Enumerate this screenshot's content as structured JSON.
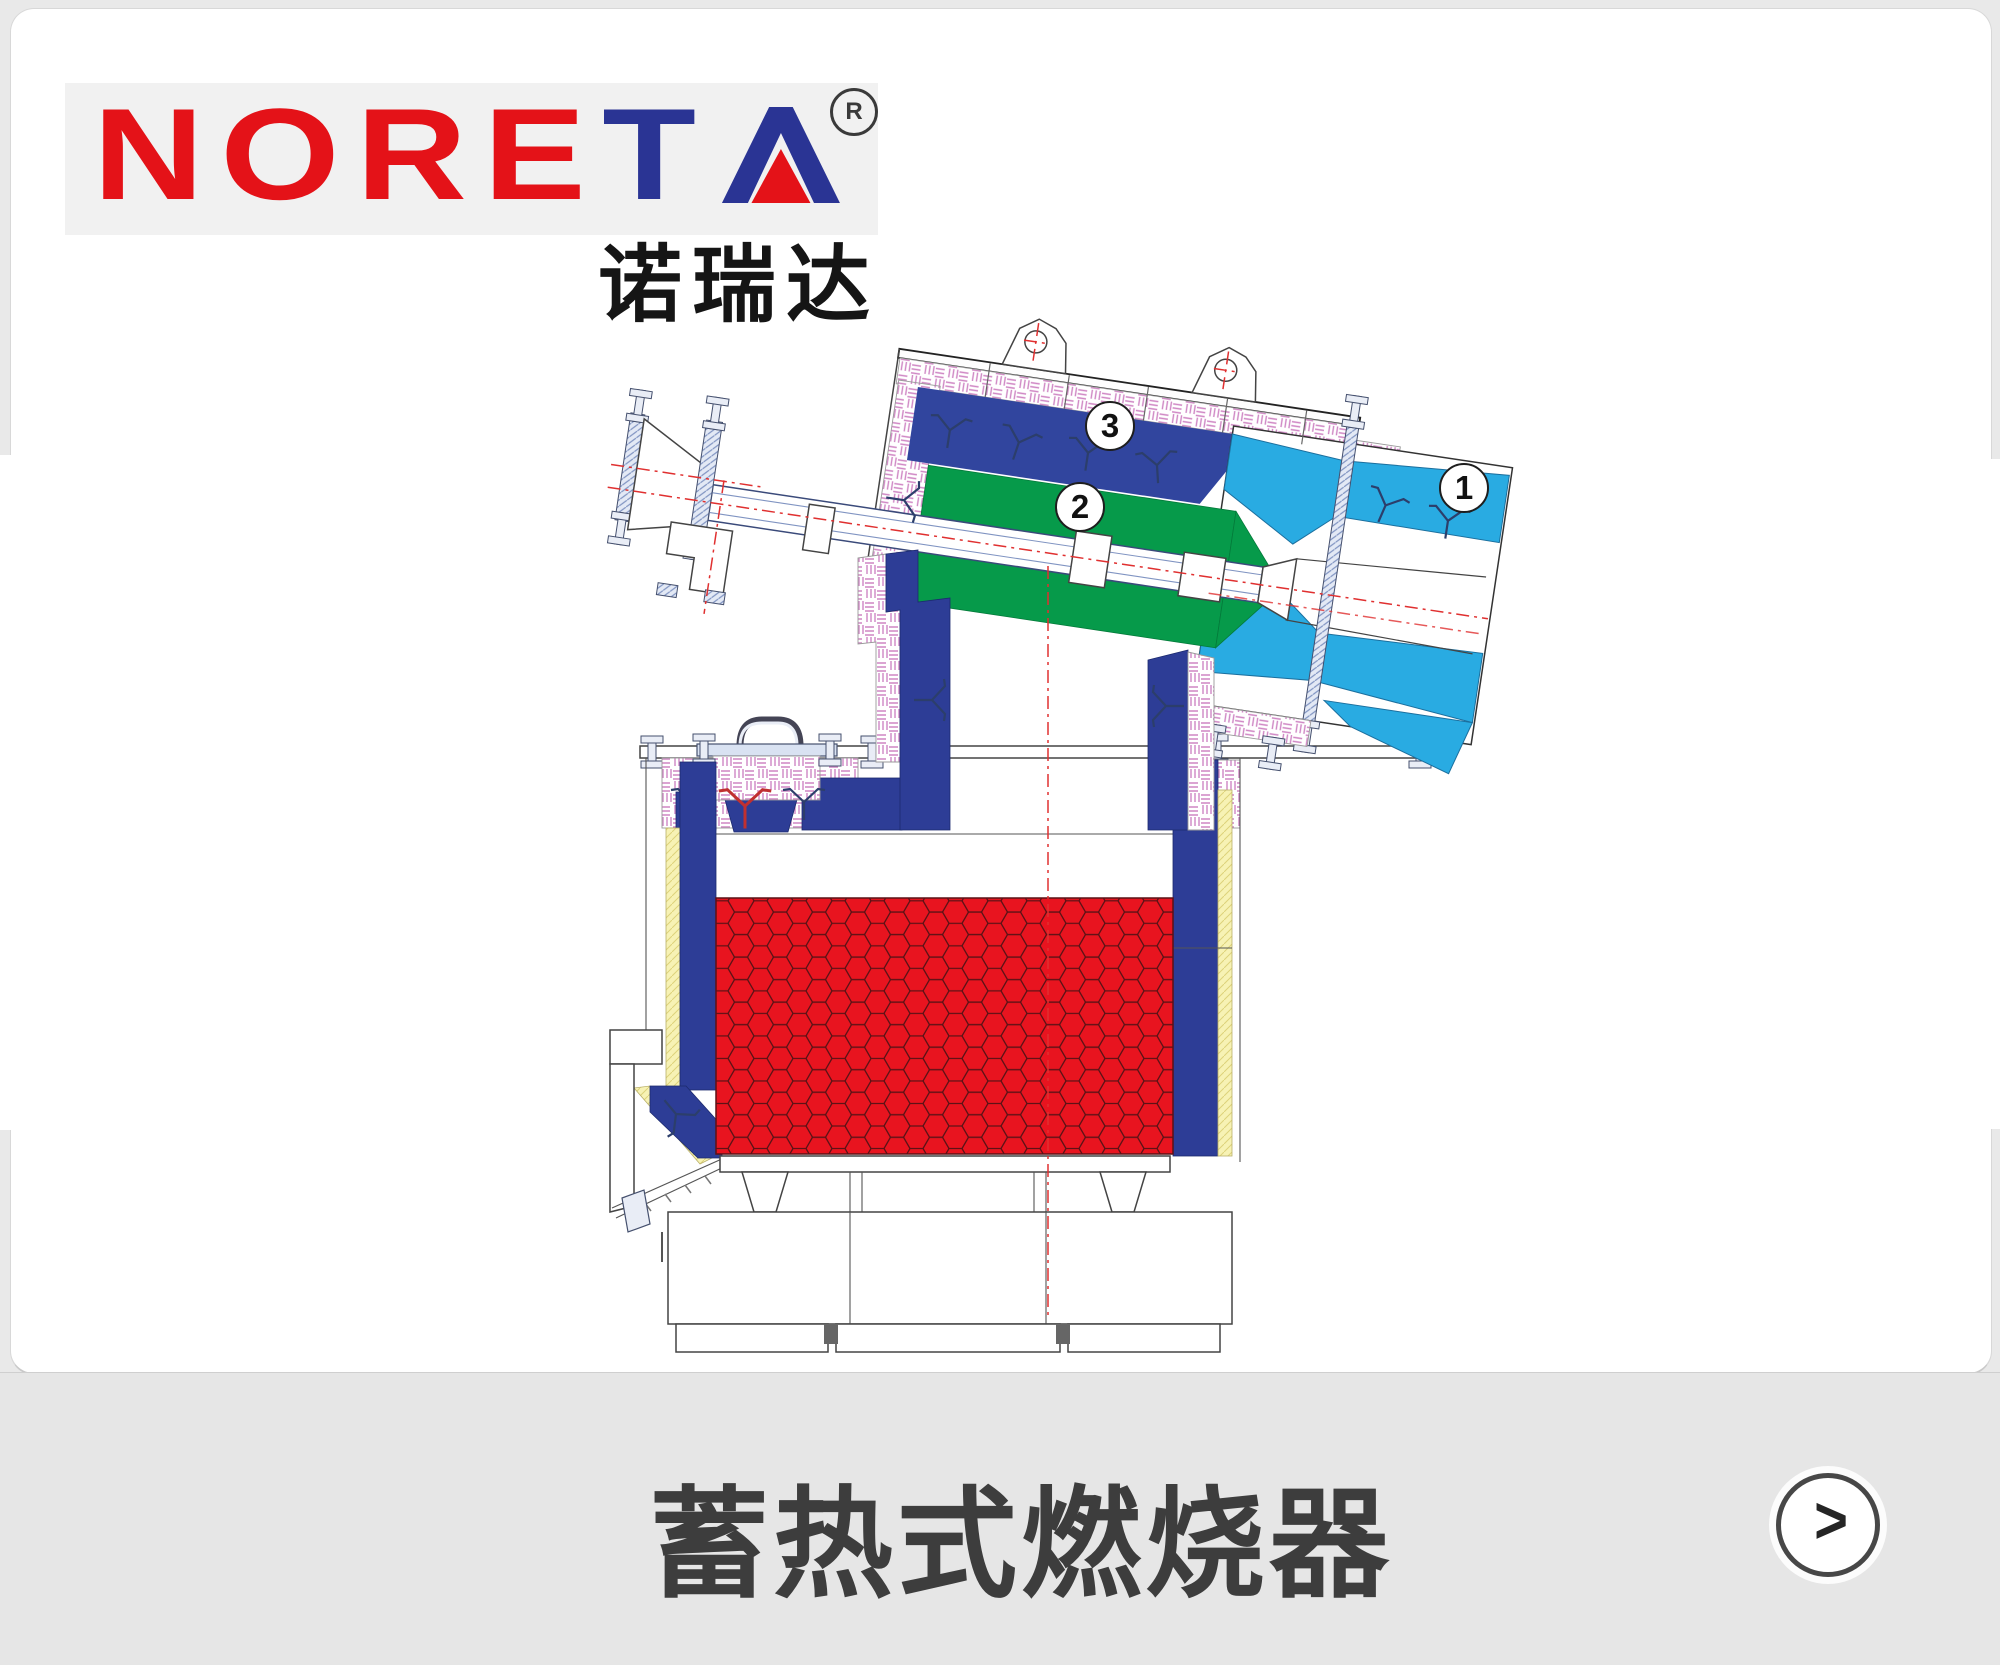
{
  "page": {
    "background_color": "#e9e9e9",
    "card_color": "#ffffff",
    "footer_color": "#e6e6e6"
  },
  "logo": {
    "wordmark_red": "NORE",
    "wordmark_blue": "T",
    "wordmark_last_letter": "A",
    "registered_mark": "R",
    "chinese_name": "诺瑞达",
    "red": "#e41218",
    "blue": "#2a3494",
    "background": "#f1f1f1"
  },
  "footer": {
    "title": "蓄热式燃烧器",
    "next_arrow": ">"
  },
  "diagram": {
    "type": "regenerative burner cross-section drawing",
    "callouts": [
      {
        "number": "1",
        "x": 1462,
        "y": 486
      },
      {
        "number": "2",
        "x": 1078,
        "y": 505
      },
      {
        "number": "3",
        "x": 1108,
        "y": 424
      }
    ],
    "colors": {
      "wall_blue": "#2d3d96",
      "lance_green": "#069a4a",
      "nozzle_cyan": "#29abe2",
      "regenerator_red": "#e8141f",
      "insulation_pink": "#cf86c4",
      "insulation_yellow": "#f7f2b4",
      "centerline_red": "#e03030"
    }
  }
}
